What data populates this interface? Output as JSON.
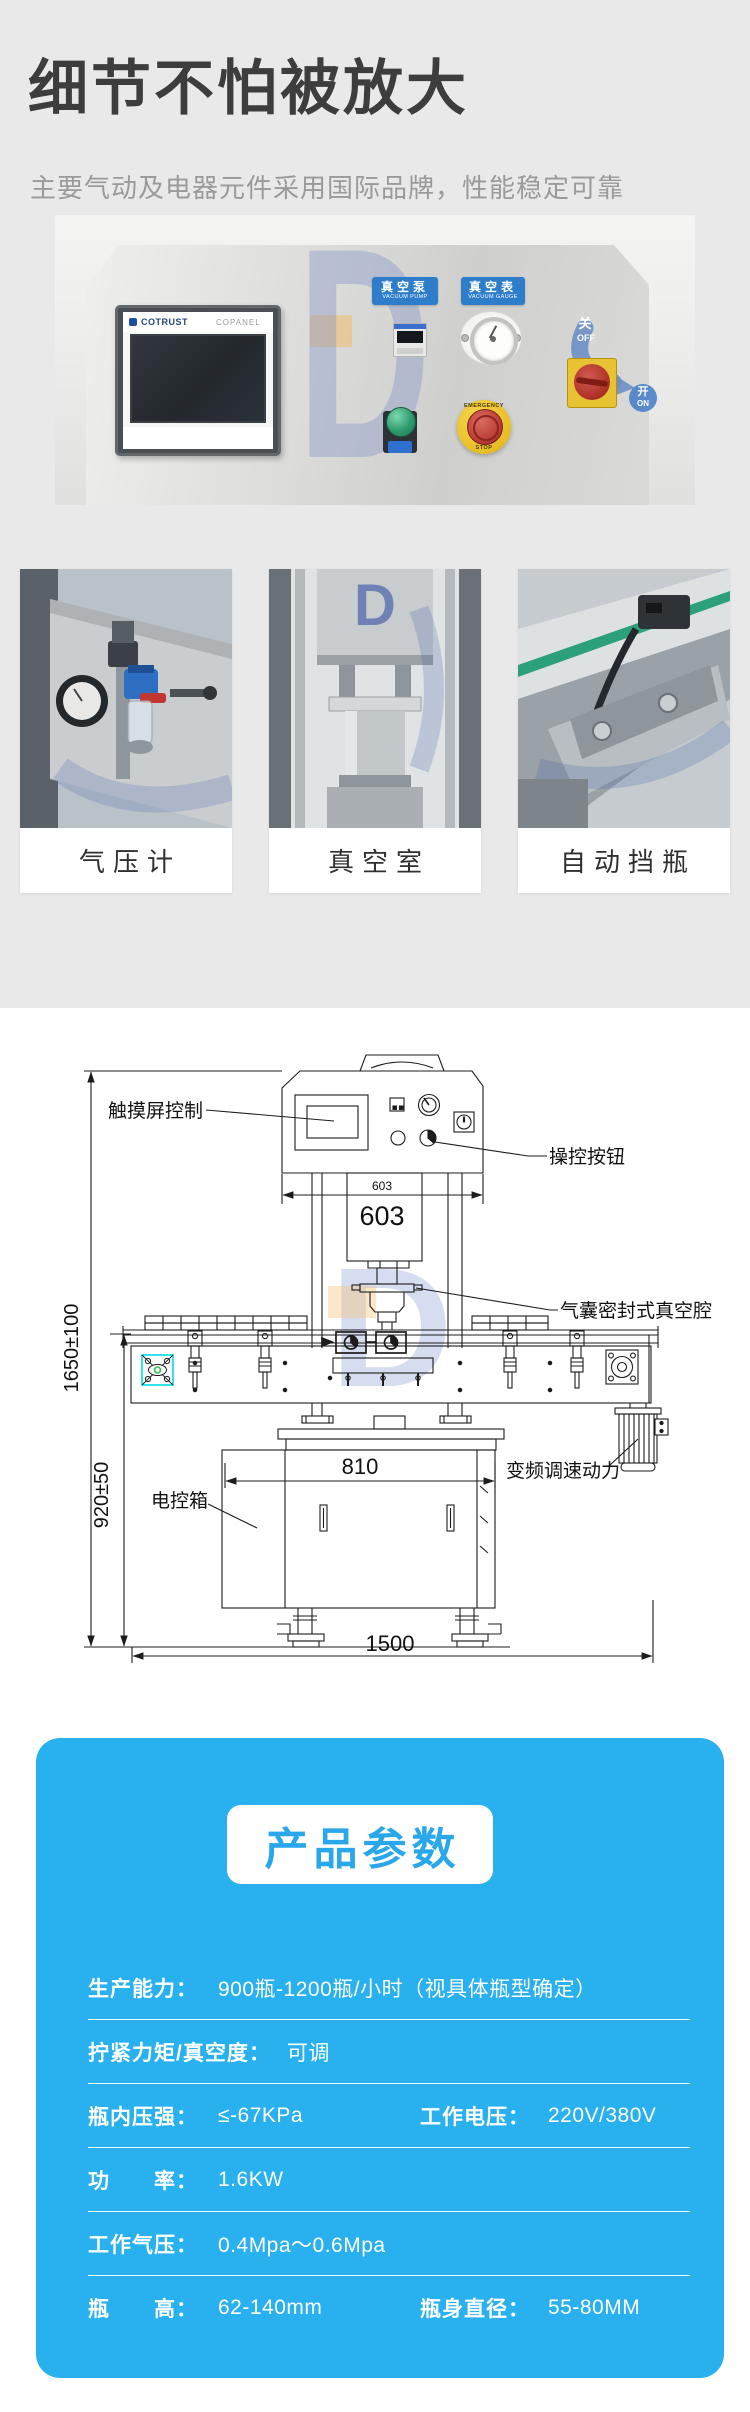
{
  "hero": {
    "title": "细节不怕被放大",
    "subtitle": "主要气动及电器元件采用国际品牌，性能稳定可靠"
  },
  "panel_photo": {
    "hmi_brand": "COTRUST",
    "hmi_model": "COPANEL",
    "vacuum_pump_cn": "真空泵",
    "vacuum_pump_en": "VACUUM PUMP",
    "vacuum_gauge_cn": "真空表",
    "vacuum_gauge_en": "VACUUM GAUGE",
    "estop_top": "EMERGENCY",
    "estop_bottom": "STOP",
    "switch_off_cn": "关",
    "switch_off_en": "OFF",
    "switch_on_cn": "开",
    "switch_on_en": "ON",
    "watermark": "D"
  },
  "feature_cards": [
    {
      "caption": "气压计"
    },
    {
      "caption": "真空室"
    },
    {
      "caption": "自动挡瓶"
    }
  ],
  "diagram": {
    "watermark": "D",
    "callouts": {
      "touchscreen": "触摸屏控制",
      "control_buttons": "操控按钮",
      "vacuum_chamber": "气囊密封式真空腔",
      "electric_box": "电控箱",
      "vfd_drive": "变频调速动力"
    },
    "dimensions": {
      "head_width_small": "603",
      "head_width": "603",
      "cabinet_width": "810",
      "total_width": "1500",
      "total_height": "1650±100",
      "table_height": "920±50"
    }
  },
  "specs": {
    "title": "产品参数",
    "rows": [
      {
        "cols": [
          {
            "label": "生产能力：",
            "value": "900瓶-1200瓶/小时（视具体瓶型确定）"
          }
        ]
      },
      {
        "cols": [
          {
            "label": "拧紧力矩/真空度：",
            "value": "可调"
          }
        ]
      },
      {
        "cols": [
          {
            "label": "瓶内压强：",
            "value": "≤-67KPa"
          },
          {
            "label": "工作电压：",
            "value": "220V/380V"
          }
        ]
      },
      {
        "cols": [
          {
            "label": "功　　率：",
            "value": "1.6KW"
          }
        ]
      },
      {
        "cols": [
          {
            "label": "工作气压：",
            "value": "0.4Mpa～0.6Mpa"
          }
        ]
      },
      {
        "cols": [
          {
            "label": "瓶　　高：",
            "value": "62-140mm"
          },
          {
            "label": "瓶身直径：",
            "value": "55-80MM"
          }
        ]
      }
    ]
  },
  "colors": {
    "accent_blue": "#28b0ef",
    "badge_text_blue": "#29a7ea",
    "chip_blue": "#2d7dcb",
    "highlight_cyan": "#00dbe8",
    "page_gray": "#e9e9e9"
  }
}
